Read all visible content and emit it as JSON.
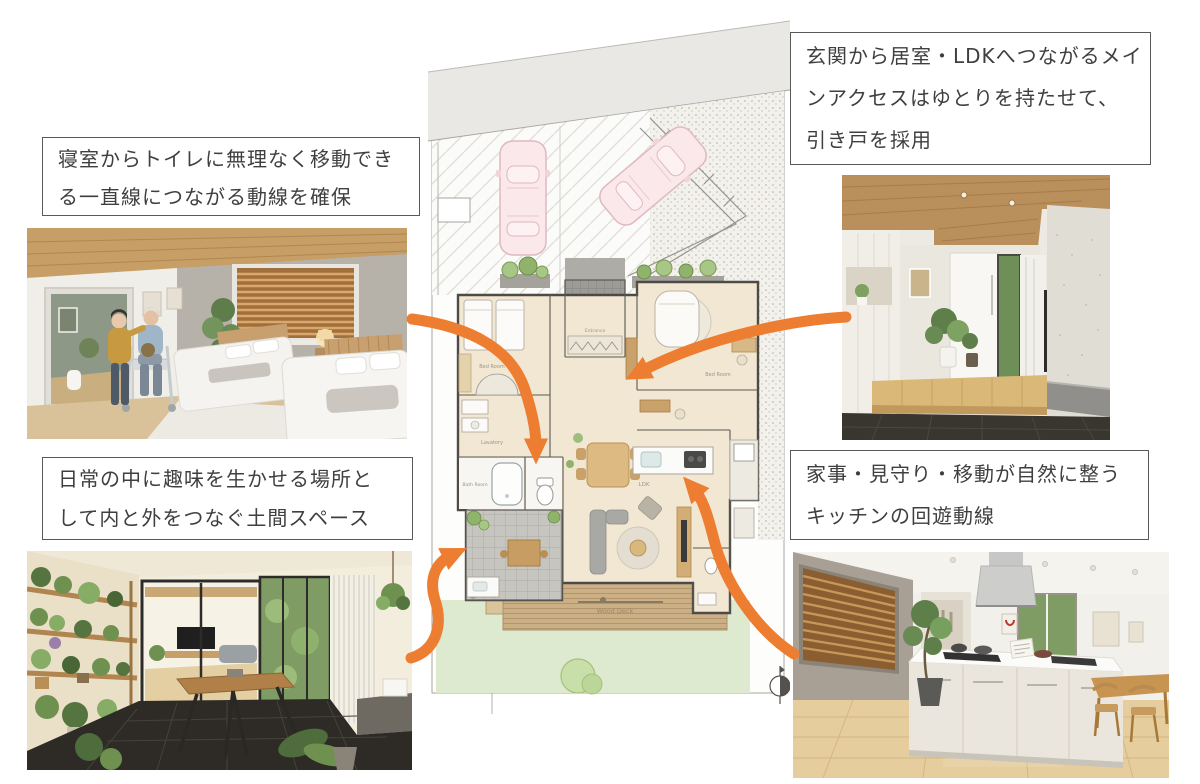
{
  "page": {
    "type": "house-plan-presentation",
    "language": "ja",
    "background": "#FFFFFF"
  },
  "callouts": {
    "bedroom_toilet": {
      "text": "寝室からトイレに無理なく移動できる一直線につながる動線を確保",
      "lines": [
        "寝室からトイレに無理なく移動でき",
        "る一直線につながる動線を確保"
      ]
    },
    "entrance_access": {
      "text": "玄関から居室・LDKへつながるメインアクセスはゆとりを持たせて、引き戸を採用",
      "lines": [
        "玄関から居室・LDKへつながるメイ",
        "ンアクセスはゆとりを持たせて、",
        "引き戸を採用"
      ]
    },
    "doma_space": {
      "text": "日常の中に趣味を生かせる場所として内と外をつなぐ土間スペース",
      "lines": [
        "日常の中に趣味を生かせる場所と",
        "して内と外をつなぐ土間スペース"
      ]
    },
    "kitchen_circulation": {
      "text": "家事・見守り・移動が自然に整うキッチンの回遊動線",
      "lines": [
        "家事・見守り・移動が自然に整う",
        "キッチンの回遊動線"
      ]
    }
  },
  "floor_plan": {
    "labels": {
      "bedroom1": "Bed Room",
      "lavatory": "Lavatory",
      "bathroom": "Bath Room",
      "entrance": "Entrance",
      "bedroom2": "Bed Room",
      "ldk": "LDK",
      "wood_deck": "Wood Deck"
    }
  },
  "colors": {
    "arrow": "#ED7D31",
    "callout_border": "#595959",
    "callout_text": "#3F3F3F",
    "car": "#FAE8EB",
    "lawn": "#DEEAD0",
    "deck": "#CBB086"
  }
}
